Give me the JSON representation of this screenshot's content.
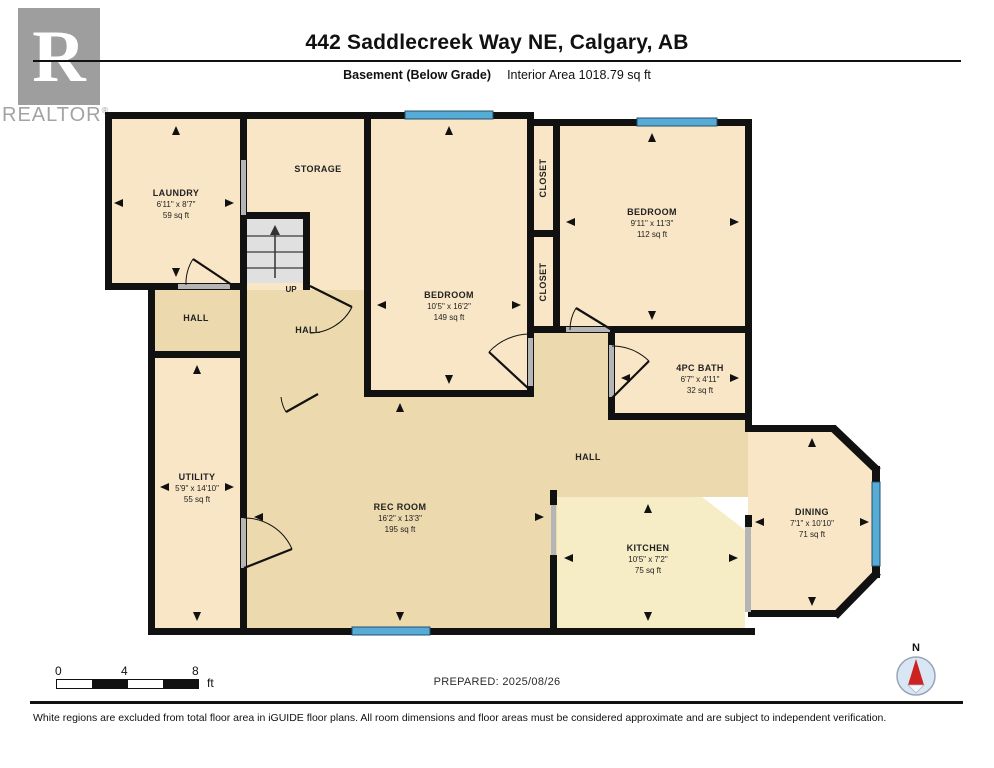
{
  "header": {
    "title": "442 Saddlecreek Way NE, Calgary, AB",
    "floor_label": "Basement (Below Grade)",
    "area_label": "Interior Area 1018.79 sq ft",
    "logo_letter": "R",
    "logo_brand": "REALTOR",
    "logo_reg": "®"
  },
  "rooms": {
    "laundry": {
      "name": "LAUNDRY",
      "dims": "6'11\" x 8'7\"",
      "area": "59 sq ft"
    },
    "storage": {
      "name": "STORAGE"
    },
    "closet_upper": {
      "name": "CLOSET"
    },
    "closet_lower": {
      "name": "CLOSET"
    },
    "bedroom_middle": {
      "name": "BEDROOM",
      "dims": "10'5\" x 16'2\"",
      "area": "149 sq ft"
    },
    "bedroom_right": {
      "name": "BEDROOM",
      "dims": "9'11\" x 11'3\"",
      "area": "112 sq ft"
    },
    "bath": {
      "name": "4PC BATH",
      "dims": "6'7\" x 4'11\"",
      "area": "32 sq ft"
    },
    "hall_left": {
      "name": "HALL"
    },
    "hall_center": {
      "name": "HALL"
    },
    "hall_main": {
      "name": "HALL"
    },
    "utility": {
      "name": "UTILITY",
      "dims": "5'9\" x 14'10\"",
      "area": "55 sq ft"
    },
    "rec_room": {
      "name": "REC ROOM",
      "dims": "16'2\" x 13'3\"",
      "area": "195 sq ft"
    },
    "kitchen": {
      "name": "KITCHEN",
      "dims": "10'5\" x 7'2\"",
      "area": "75 sq ft"
    },
    "dining": {
      "name": "DINING",
      "dims": "7'1\" x 10'10\"",
      "area": "71 sq ft"
    }
  },
  "stairs": {
    "label": "UP"
  },
  "scale": {
    "ticks": [
      "0",
      "4",
      "8"
    ],
    "unit": "ft"
  },
  "prepared": {
    "text": "PREPARED: 2025/08/26"
  },
  "compass": {
    "label": "N"
  },
  "disclaimer": {
    "text": "White regions are excluded from total floor area in iGUIDE floor plans. All room dimensions and floor areas must be considered approximate and are subject to independent verification."
  },
  "colors": {
    "room_fill": "#f8e6c6",
    "hall_fill": "#ecd9ae",
    "kitchen_fill": "#f6edc6",
    "wall": "#111111",
    "window_blue": "#56abd7",
    "stairs_gray": "#e0e0e0",
    "door_opening_gray": "#b5b5b5",
    "compass_circle": "#d9e6f4",
    "needle_red": "#cc2222"
  }
}
